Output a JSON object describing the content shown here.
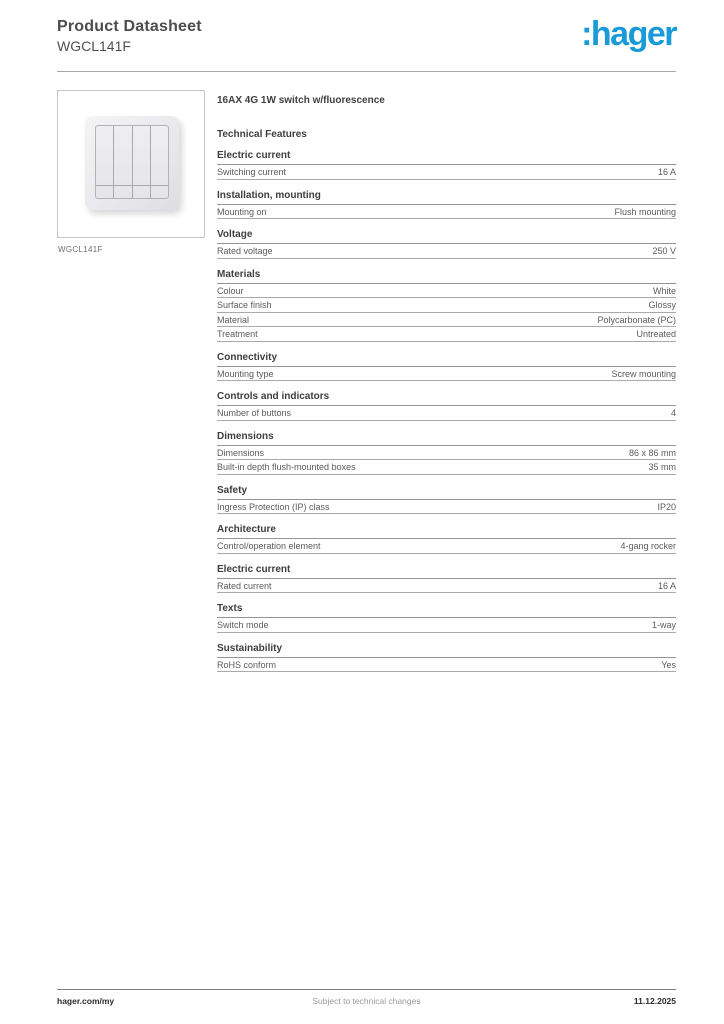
{
  "header": {
    "title": "Product Datasheet",
    "subtitle": "WGCL141F",
    "logo_text": ":hager",
    "logo_color": "#189bd7"
  },
  "figure": {
    "caption": "WGCL141F"
  },
  "tech": {
    "product_name": "16AX 4G 1W switch w/fluorescence",
    "heading": "Technical Features",
    "sections": [
      {
        "heading": "Electric current",
        "rows": [
          {
            "label": "Switching current",
            "value": "16 A"
          }
        ]
      },
      {
        "heading": "Installation, mounting",
        "rows": [
          {
            "label": "Mounting on",
            "value": "Flush mounting"
          }
        ]
      },
      {
        "heading": "Voltage",
        "rows": [
          {
            "label": "Rated voltage",
            "value": "250 V"
          }
        ]
      },
      {
        "heading": "Materials",
        "rows": [
          {
            "label": "Colour",
            "value": "White"
          },
          {
            "label": "Surface finish",
            "value": "Glossy"
          },
          {
            "label": "Material",
            "value": "Polycarbonate (PC)"
          },
          {
            "label": "Treatment",
            "value": "Untreated"
          }
        ]
      },
      {
        "heading": "Connectivity",
        "rows": [
          {
            "label": "Mounting type",
            "value": "Screw mounting"
          }
        ]
      },
      {
        "heading": "Controls and indicators",
        "rows": [
          {
            "label": "Number of buttons",
            "value": "4"
          }
        ]
      },
      {
        "heading": "Dimensions",
        "rows": [
          {
            "label": "Dimensions",
            "value": "86 x 86 mm"
          },
          {
            "label": "Built-in depth flush-mounted boxes",
            "value": "35 mm"
          }
        ]
      },
      {
        "heading": "Safety",
        "rows": [
          {
            "label": "Ingress Protection (IP) class",
            "value": "IP20"
          }
        ]
      },
      {
        "heading": "Architecture",
        "rows": [
          {
            "label": "Control/operation element",
            "value": "4-gang rocker"
          }
        ]
      },
      {
        "heading": "Electric current",
        "rows": [
          {
            "label": "Rated current",
            "value": "16 A"
          }
        ]
      },
      {
        "heading": "Texts",
        "rows": [
          {
            "label": "Switch mode",
            "value": "1-way"
          }
        ]
      },
      {
        "heading": "Sustainability",
        "rows": [
          {
            "label": "RoHS conform",
            "value": "Yes"
          }
        ]
      }
    ]
  },
  "footer": {
    "left": "hager.com/my",
    "center": "Subject to technical changes",
    "right": "11.12.2025"
  }
}
